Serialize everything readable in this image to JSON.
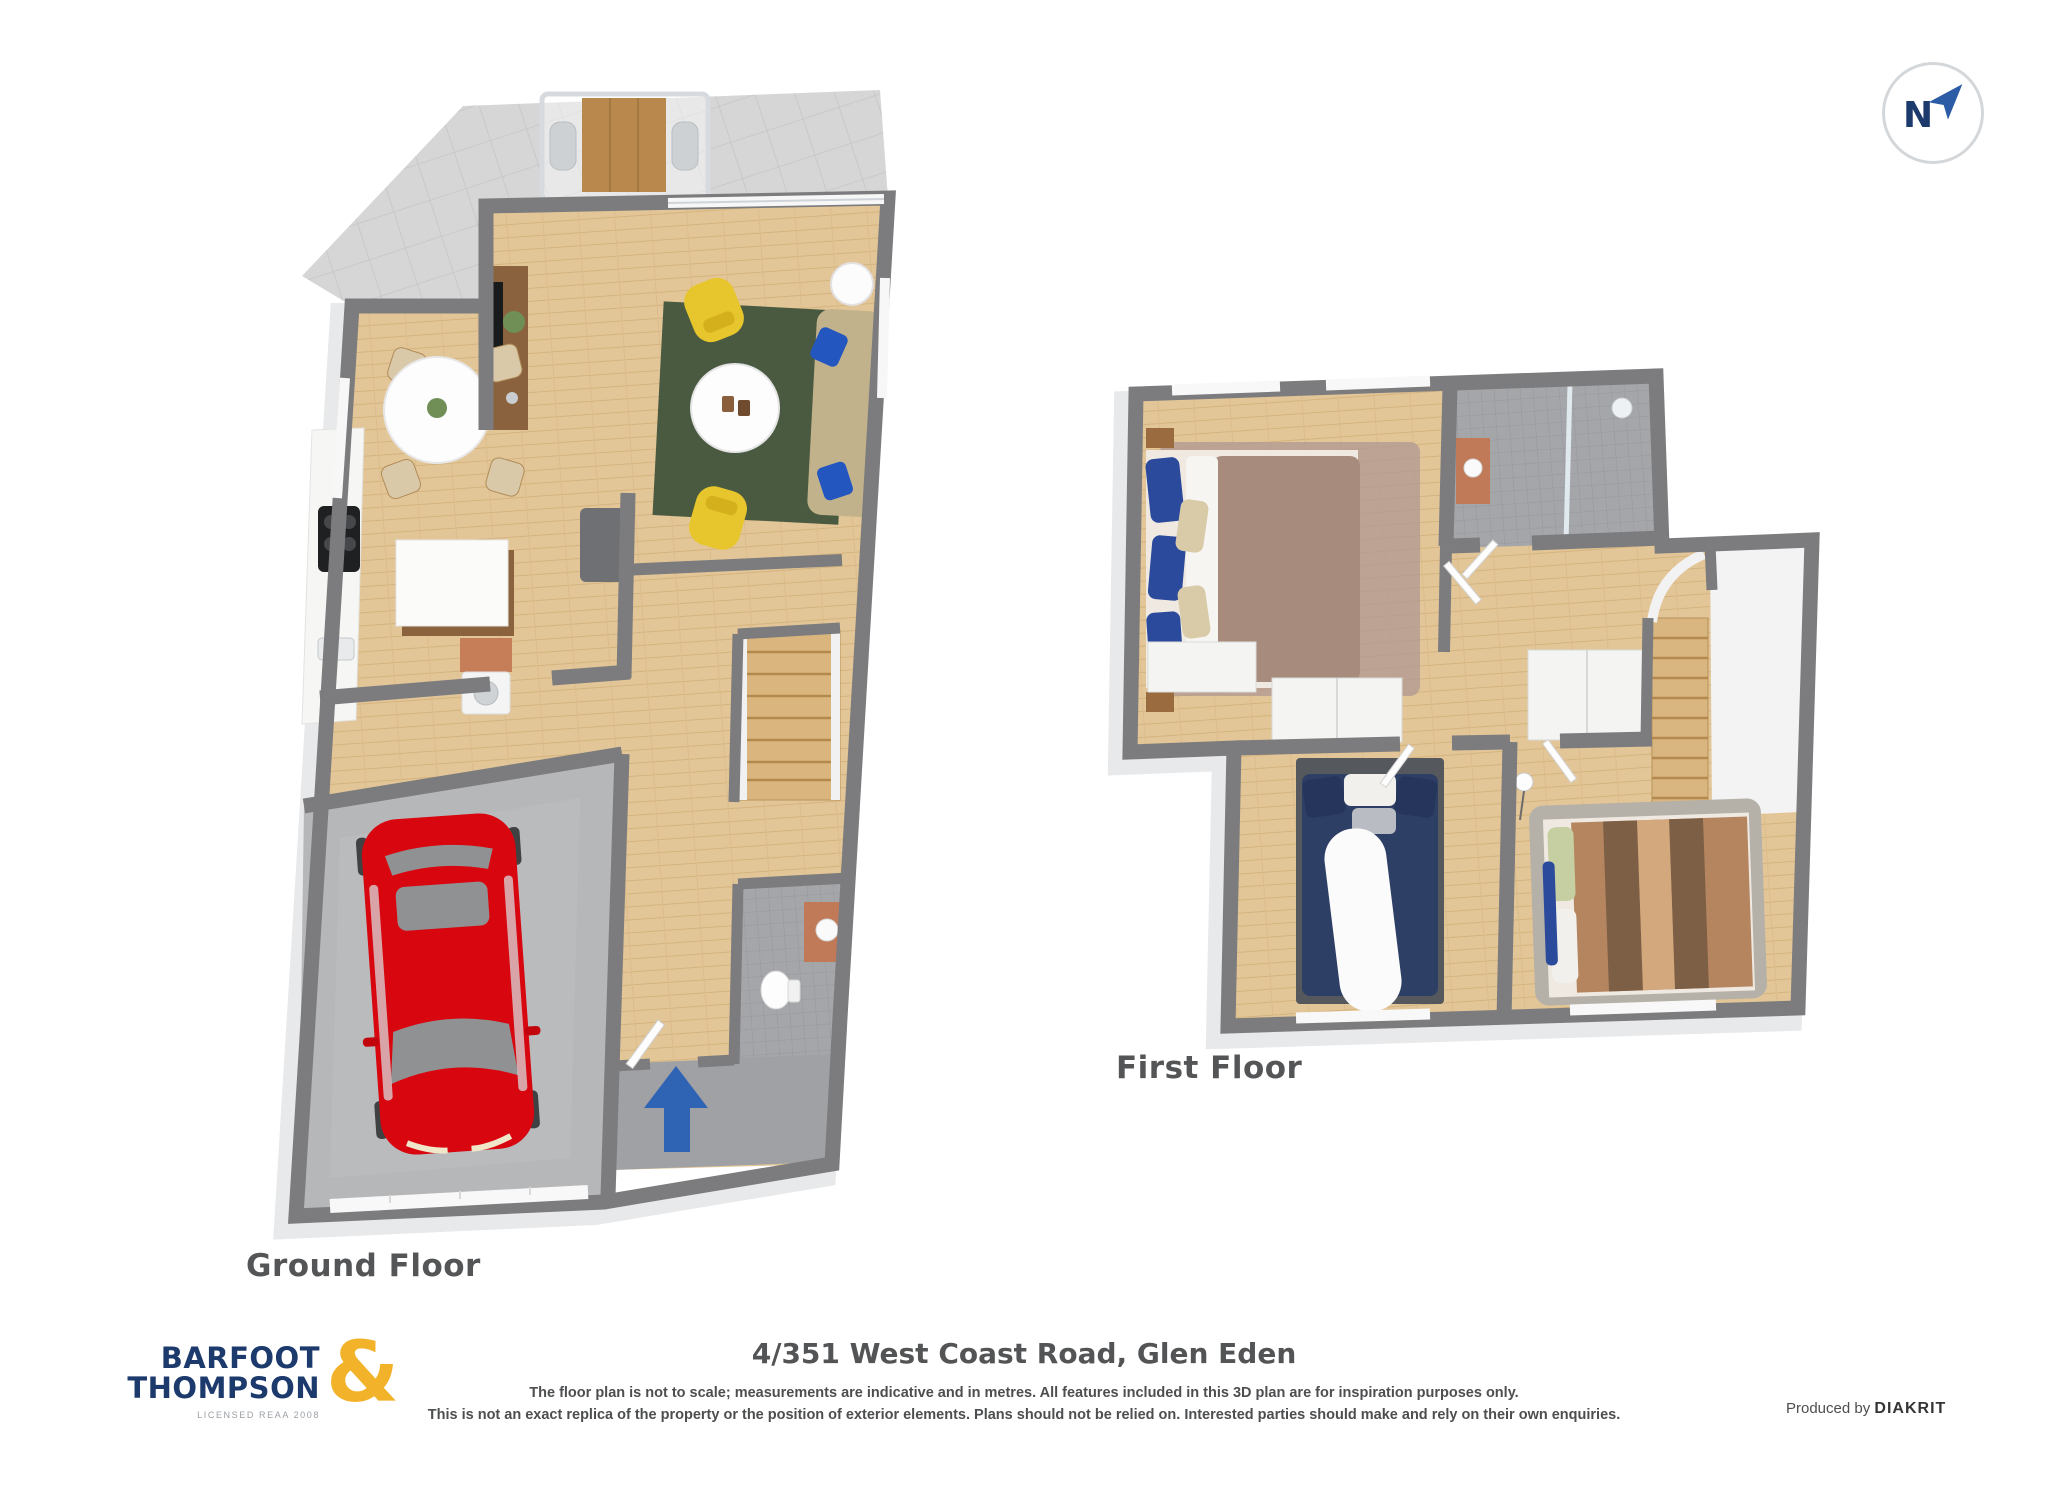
{
  "compass": {
    "letter": "N"
  },
  "floors": {
    "ground": {
      "label": "Ground Floor"
    },
    "first": {
      "label": "First Floor"
    }
  },
  "footer": {
    "logo": {
      "line1": "BARFOOT",
      "line2": "THOMPSON",
      "ampersand": "&",
      "tagline": "LICENSED REAA 2008"
    },
    "address": "4/351 West Coast Road, Glen Eden",
    "disclaimer1": "The floor plan is not to scale; measurements are indicative and in metres. All features included in this 3D plan are for inspiration purposes only.",
    "disclaimer2": "This is not an exact replica of the property or the position of exterior elements. Plans should not be relied on. Interested parties should make and rely on their own enquiries.",
    "produced_by": "Produced by",
    "producer": "DIAKRIT"
  },
  "colors": {
    "brand_navy": "#1d3a6d",
    "brand_gold": "#f2b32a",
    "compass_arrow": "#2c5ca6",
    "wall_gray": "#7c7c7e",
    "wood": "#e3c697",
    "tile_gray": "#d6d6d6",
    "bath_tile": "#98a2ad",
    "concrete": "#b6b7b9",
    "porch_concrete": "#9fa1a5",
    "car_red": "#d8060f",
    "arrow_blue": "#2f63b4",
    "rug_green": "#4a5a40",
    "chair_yellow": "#e7c52d",
    "sofa_beige": "#c1b28c",
    "duvet_mauve": "#a78c7d",
    "duvet_navy": "#2e3f66",
    "duvet_brown": "#b5855f",
    "cabinet_walnut": "#8a623e"
  }
}
